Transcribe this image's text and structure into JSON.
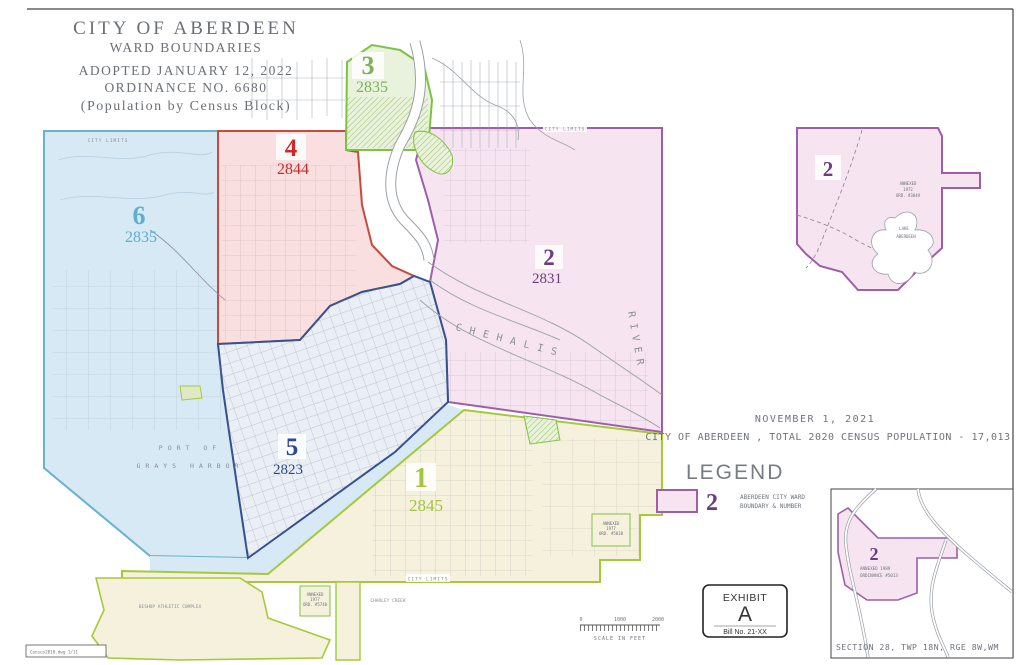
{
  "sheet": {
    "title_block": {
      "line1": "CITY OF ABERDEEN",
      "line2": "WARD BOUNDARIES",
      "line3": "ADOPTED JANUARY 12, 2022",
      "line4": "ORDINANCE NO. 6680",
      "line5": "(Population by Census Block)"
    },
    "file_note": "Census2010.dwg  1/11"
  },
  "wards": {
    "w1": {
      "number": "1",
      "population": "2845",
      "fill": "#f5f1dd",
      "border": "#a6c93c",
      "text_color": "#a3c53e"
    },
    "w2": {
      "number": "2",
      "population": "2831",
      "fill": "#f6e4f0",
      "border": "#9e5fa8",
      "text_color": "#6a3d80"
    },
    "w3": {
      "number": "3",
      "population": "2835",
      "fill": "#e9f2dc",
      "border": "#7dc242",
      "text_color": "#7cb357"
    },
    "w4": {
      "number": "4",
      "population": "2844",
      "fill": "#f9dfdf",
      "border": "#c74a3c",
      "text_color": "#cc2a2a"
    },
    "w5": {
      "number": "5",
      "population": "2823",
      "fill": "#eaeff6",
      "border": "#37508f",
      "text_color": "#2e4a8c"
    },
    "w6": {
      "number": "6",
      "population": "2835",
      "fill": "#d6e9f4",
      "border": "#6ab1d0",
      "text_color": "#62aec9"
    }
  },
  "map_labels": {
    "city_limits": "CITY LIMITS",
    "chehalis": "CHEHALIS",
    "river": "RIVER",
    "port_line1": "PORT OF",
    "port_line2": "GRAYS HARBOR",
    "bishop": "BISHOP ATHLETIC COMPLEX",
    "charley_creek": "CHARLEY CREEK"
  },
  "annotations": {
    "date": "NOVEMBER 1, 2021",
    "census": "CITY OF ABERDEEN , TOTAL 2020 CENSUS POPULATION - 17,013"
  },
  "legend": {
    "title": "LEGEND",
    "sample_number": "2",
    "label_line1": "ABERDEEN CITY WARD",
    "label_line2": "BOUNDARY & NUMBER",
    "swatch_fill": "#f6e4f0",
    "swatch_border": "#9e5fa8"
  },
  "exhibit": {
    "title": "EXHIBIT",
    "letter": "A",
    "bill": "Bill No. 21-XX"
  },
  "inset_top_right": {
    "ward_number": "2",
    "annex_line1": "ANNEXED",
    "annex_line2": "1972",
    "annex_line3": "ORD. #3049",
    "lake_line1": "LAKE",
    "lake_line2": "ABERDEEN"
  },
  "inset_bottom_right": {
    "ward_number": "2",
    "annex_line1": "ANNEXED    1989",
    "annex_line2": "ORDINANCE  #5013",
    "section": "SECTION 28, TWP 18N, RGE 8W,WM"
  },
  "annex_notes": {
    "a1_line1": "ANNEXED",
    "a1_line2": "1977",
    "a1_line3": "ORD. #5740",
    "a2_line1": "ANNEXED",
    "a2_line2": "1977",
    "a2_line3": "ORD. #5038"
  },
  "scale_bar": {
    "t0": "0",
    "t1": "1000",
    "t2": "2000",
    "caption": "SCALE IN FEET"
  }
}
